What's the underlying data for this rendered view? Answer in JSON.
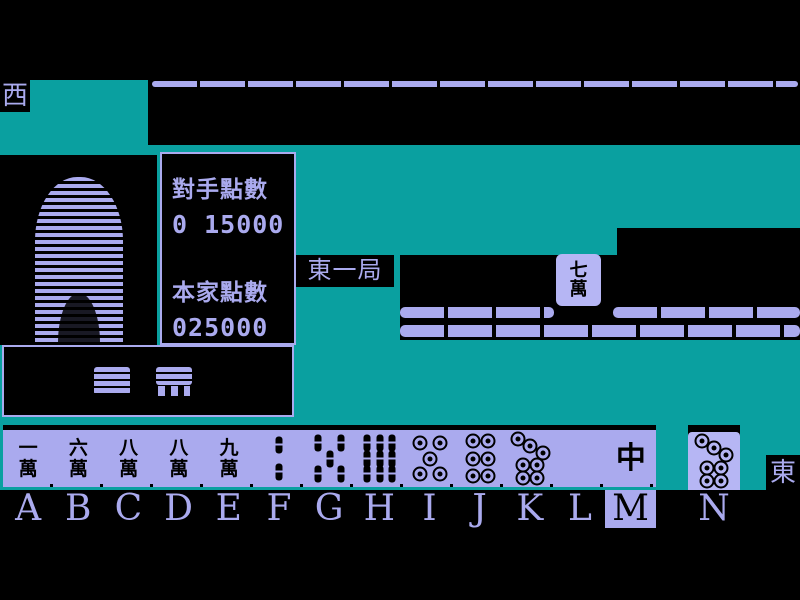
{
  "colors": {
    "teal": "#0aa0a0",
    "purple": "#aaaaee",
    "tile_face": "#b6b6f4",
    "background": "#000000"
  },
  "indicators": {
    "west_seat": "西",
    "east_seat": "東",
    "round": "東一局"
  },
  "score_panel": {
    "opponent_label": "對手點數",
    "opponent_points": "0 15000",
    "player_label": "本家點數",
    "player_points": "025000"
  },
  "opponent": {
    "figure": "striped-silhouette",
    "wall_tiles": "face-down-row"
  },
  "discard_tile": {
    "name": "7-characters",
    "chars": [
      "七",
      "萬"
    ]
  },
  "hand": {
    "selected_key": "M",
    "tiles": [
      {
        "key": "A",
        "kind": "man",
        "name": "1-characters",
        "chars": [
          "一",
          "萬"
        ]
      },
      {
        "key": "B",
        "kind": "man",
        "name": "6-characters",
        "chars": [
          "六",
          "萬"
        ]
      },
      {
        "key": "C",
        "kind": "man",
        "name": "8-characters",
        "chars": [
          "八",
          "萬"
        ]
      },
      {
        "key": "D",
        "kind": "man",
        "name": "8-characters",
        "chars": [
          "八",
          "萬"
        ]
      },
      {
        "key": "E",
        "kind": "man",
        "name": "9-characters",
        "chars": [
          "九",
          "萬"
        ]
      },
      {
        "key": "F",
        "kind": "sou",
        "name": "2-bamboo",
        "dots": [
          [
            50,
            26
          ],
          [
            50,
            74
          ]
        ]
      },
      {
        "key": "G",
        "kind": "sou",
        "name": "5-bamboo",
        "dots": [
          [
            27,
            22
          ],
          [
            73,
            22
          ],
          [
            50,
            50
          ],
          [
            27,
            78
          ],
          [
            73,
            78
          ]
        ]
      },
      {
        "key": "H",
        "kind": "sou",
        "name": "9-bamboo",
        "dots": [
          [
            25,
            22
          ],
          [
            50,
            22
          ],
          [
            75,
            22
          ],
          [
            25,
            50
          ],
          [
            50,
            50
          ],
          [
            75,
            50
          ],
          [
            25,
            78
          ],
          [
            50,
            78
          ],
          [
            75,
            78
          ]
        ]
      },
      {
        "key": "I",
        "kind": "pin",
        "name": "5-circles",
        "dots": [
          [
            30,
            22
          ],
          [
            70,
            22
          ],
          [
            50,
            50
          ],
          [
            30,
            78
          ],
          [
            70,
            78
          ]
        ]
      },
      {
        "key": "J",
        "kind": "pin",
        "name": "6-circles",
        "dots": [
          [
            35,
            20
          ],
          [
            65,
            20
          ],
          [
            35,
            50
          ],
          [
            65,
            50
          ],
          [
            35,
            80
          ],
          [
            65,
            80
          ]
        ]
      },
      {
        "key": "K",
        "kind": "pin",
        "name": "7-circles",
        "dots": [
          [
            26,
            16
          ],
          [
            50,
            28
          ],
          [
            74,
            40
          ],
          [
            36,
            62
          ],
          [
            64,
            62
          ],
          [
            36,
            84
          ],
          [
            64,
            84
          ]
        ]
      },
      {
        "key": "L",
        "kind": "blank",
        "name": "empty-slot"
      },
      {
        "key": "M",
        "kind": "honor",
        "name": "red-dragon",
        "chars": [
          "中"
        ]
      }
    ],
    "drawn_tile": {
      "key": "N",
      "kind": "pin",
      "name": "7-circles",
      "dots": [
        [
          26,
          16
        ],
        [
          50,
          28
        ],
        [
          74,
          40
        ],
        [
          36,
          62
        ],
        [
          64,
          62
        ],
        [
          36,
          84
        ],
        [
          64,
          84
        ]
      ]
    }
  }
}
